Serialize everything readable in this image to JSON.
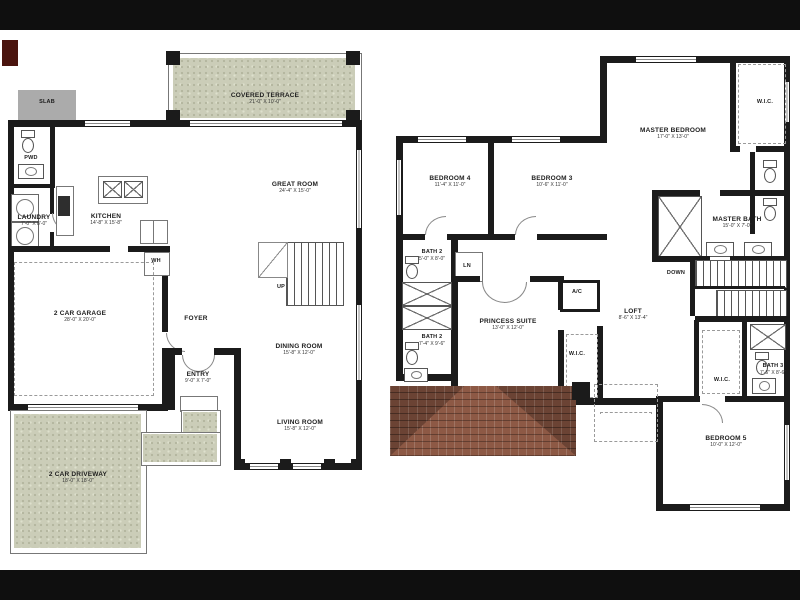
{
  "colors": {
    "background": "#ffffff",
    "letterbox": "#0f0f0f",
    "walls": "#1b1b1b",
    "terrace_texture": "#cbcdb8",
    "driveway_texture": "#cbcdb8",
    "slab_gray": "#ababab",
    "roof_brown": "#8d5945",
    "accent_red": "#4a140e"
  },
  "first_floor": {
    "covered_terrace": {
      "name": "COVERED TERRACE",
      "dims": "21'-0\" X 10'-0\""
    },
    "slab": {
      "name": "SLAB"
    },
    "pwd": {
      "name": "PWD"
    },
    "laundry": {
      "name": "LAUNDRY",
      "dims": "7'-0\" X 8'-0\""
    },
    "kitchen": {
      "name": "KITCHEN",
      "dims": "14'-8\" X 15'-8\""
    },
    "great_room": {
      "name": "GREAT ROOM",
      "dims": "24'-4\" X 15'-0\""
    },
    "wh": {
      "name": "WH"
    },
    "garage": {
      "name": "2 CAR GARAGE",
      "dims": "28'-0\" X 20'-0\""
    },
    "foyer": {
      "name": "FOYER"
    },
    "up": {
      "name": "UP"
    },
    "dining_room": {
      "name": "DINING ROOM",
      "dims": "15'-8\" X 12'-0\""
    },
    "entry": {
      "name": "ENTRY",
      "dims": "9'-0\" X 7'-0\""
    },
    "living_room": {
      "name": "LIVING ROOM",
      "dims": "15'-8\" X 12'-0\""
    },
    "driveway": {
      "name": "2 CAR DRIVEWAY",
      "dims": "18'-0\" X 18'-0\""
    }
  },
  "second_floor": {
    "master_bedroom": {
      "name": "MASTER BEDROOM",
      "dims": "17'-0\" X 13'-0\""
    },
    "wic_master": {
      "name": "W.I.C."
    },
    "master_bath": {
      "name": "MASTER BATH",
      "dims": "15'-0\" X 7'-0\""
    },
    "bedroom4": {
      "name": "BEDROOM 4",
      "dims": "11'-4\" X 11'-0\""
    },
    "bedroom3": {
      "name": "BEDROOM 3",
      "dims": "10'-6\" X 11'-0\""
    },
    "bath2a": {
      "name": "BATH 2",
      "dims": "5'-0\" X 8'-0\""
    },
    "ln": {
      "name": "LN"
    },
    "bath2b": {
      "name": "BATH 2",
      "dims": "7'-4\" X 9'-6\""
    },
    "princess_suite": {
      "name": "PRINCESS SUITE",
      "dims": "13'-0\" X 12'-0\""
    },
    "ac": {
      "name": "A/C"
    },
    "loft": {
      "name": "LOFT",
      "dims": "8'-6\" X 13'-4\""
    },
    "down": {
      "name": "DOWN"
    },
    "wic_princess": {
      "name": "W.I.C."
    },
    "wic_bed5": {
      "name": "W.I.C."
    },
    "bath3": {
      "name": "BATH 3",
      "dims": "7'-6\" X 8'-6\""
    },
    "bedroom5": {
      "name": "BEDROOM 5",
      "dims": "10'-0\" X 12'-0\""
    }
  }
}
